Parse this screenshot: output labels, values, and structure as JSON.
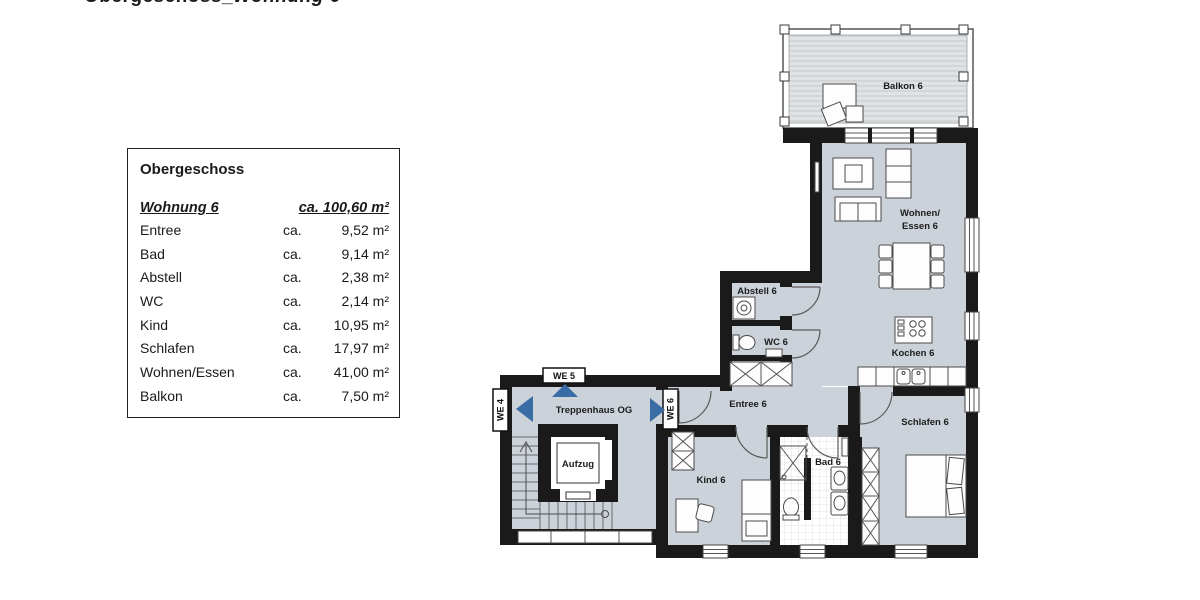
{
  "title": {
    "part1": "Obergeschoss_",
    "part2": "Wohnung 6"
  },
  "legend": {
    "heading": "Obergeschoss",
    "header": {
      "unit": "Wohnung 6",
      "area": "ca. 100,60 m²"
    },
    "rows": [
      {
        "name": "Entree",
        "ca": "ca.",
        "area": "9,52 m²"
      },
      {
        "name": "Bad",
        "ca": "ca.",
        "area": "9,14 m²"
      },
      {
        "name": "Abstell",
        "ca": "ca.",
        "area": "2,38 m²"
      },
      {
        "name": "WC",
        "ca": "ca.",
        "area": "2,14 m²"
      },
      {
        "name": "Kind",
        "ca": "ca.",
        "area": "10,95 m²"
      },
      {
        "name": "Schlafen",
        "ca": "ca.",
        "area": "17,97 m²"
      },
      {
        "name": "Wohnen/Essen",
        "ca": "ca.",
        "area": "41,00 m²"
      },
      {
        "name": "Balkon",
        "ca": "ca.",
        "area": "7,50 m²"
      }
    ]
  },
  "plan": {
    "labels": {
      "balkon": "Balkon 6",
      "wohnen_line1": "Wohnen/",
      "wohnen_line2": "Essen 6",
      "kochen": "Kochen 6",
      "abstell": "Abstell 6",
      "wc": "WC 6",
      "treppenhaus": "Treppenhaus OG",
      "aufzug": "Aufzug",
      "entree": "Entree 6",
      "kind": "Kind 6",
      "bad": "Bad 6",
      "schlafen": "Schlafen 6",
      "we4": "WE 4",
      "we5": "WE 5",
      "we6": "WE 6"
    },
    "colors": {
      "floor": "#ccd2d9",
      "wall": "#1a1a1a",
      "arrow": "#3a6da5"
    }
  }
}
